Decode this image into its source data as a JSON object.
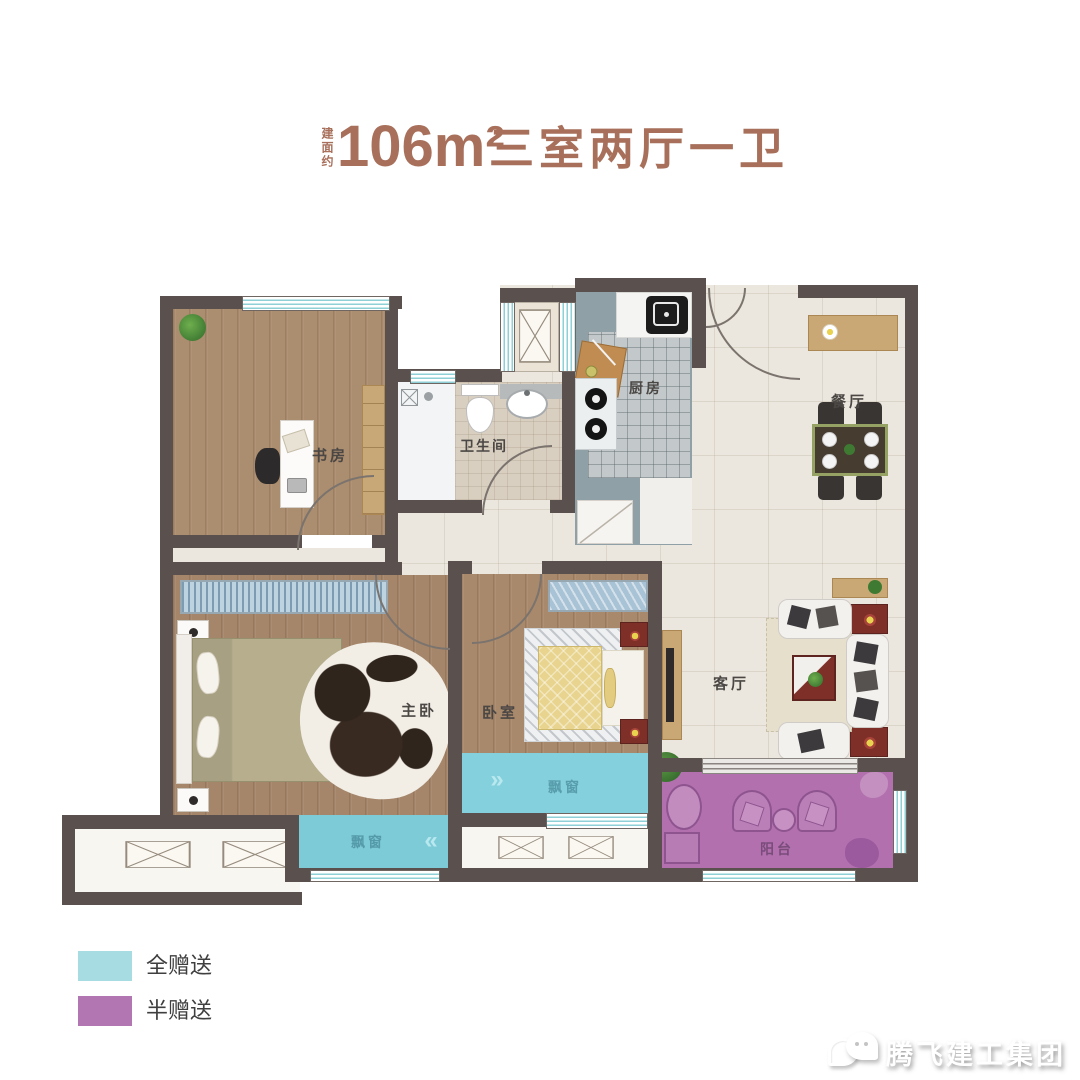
{
  "title": {
    "area_prefix": "建面约",
    "area": "106m²",
    "layout": "三室两厅一卫"
  },
  "legend": {
    "items": [
      {
        "label": "全赠送",
        "color": "#a7dce2"
      },
      {
        "label": "半赠送",
        "color": "#b277b2"
      }
    ]
  },
  "plan": {
    "colors": {
      "wall": "#5a514f",
      "wood_floor": "#a98a6c",
      "tile_floor": "#ece7de",
      "kitchen_floor": "#8fa1a6",
      "bay_window": "#7ecbd8",
      "balcony": "#b271ae"
    },
    "rooms": {
      "study": {
        "label": "书房"
      },
      "bathroom": {
        "label": "卫生间"
      },
      "kitchen": {
        "label": "厨房"
      },
      "dining": {
        "label": "餐厅"
      },
      "living": {
        "label": "客厅"
      },
      "master_bedroom": {
        "label": "主卧"
      },
      "bedroom": {
        "label": "卧室"
      },
      "balcony": {
        "label": "阳台"
      },
      "bay_window_master": {
        "label": "飘窗"
      },
      "bay_window_bedroom": {
        "label": "飘窗"
      }
    },
    "icons": {
      "chevron_left": "«",
      "chevron_right": "»"
    }
  },
  "watermark": {
    "brand": "腾飞建工集团"
  }
}
